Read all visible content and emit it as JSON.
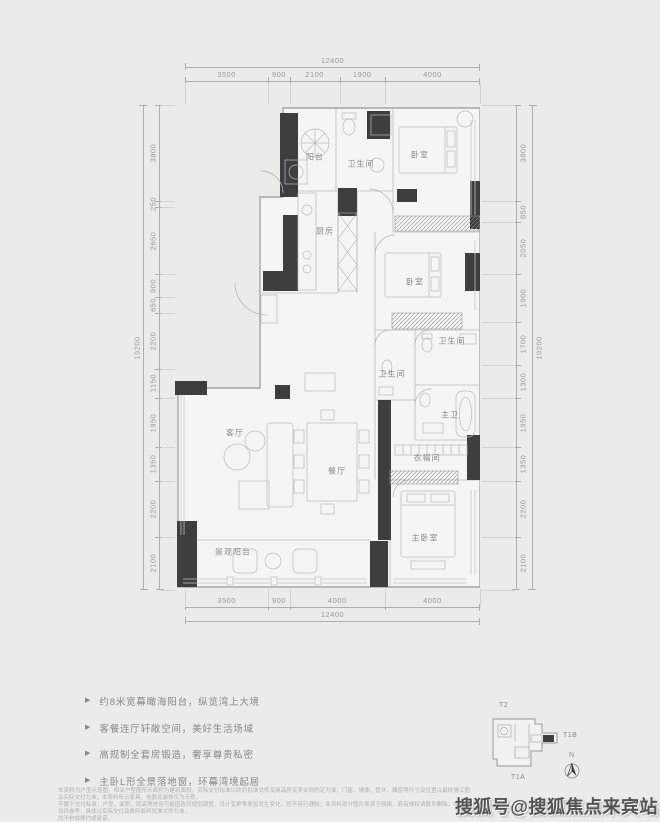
{
  "page": {
    "background": "#edebe8"
  },
  "dims": {
    "top": {
      "overall": "12400",
      "segments": [
        "3500",
        "900",
        "2100",
        "1900",
        "4000"
      ]
    },
    "bottom": {
      "overall": "12400",
      "segments": [
        "3500",
        "900",
        "4000",
        "4000"
      ]
    },
    "left": {
      "overall": "19200",
      "segments": [
        "3800",
        "250",
        "2650",
        "900",
        "650",
        "2200",
        "1150",
        "1950",
        "1350",
        "2200",
        "2100"
      ]
    },
    "right": {
      "overall": "19200",
      "segments": [
        "3800",
        "850",
        "2050",
        "1900",
        "1700",
        "1300",
        "1950",
        "1350",
        "2200",
        "2100"
      ]
    }
  },
  "plan": {
    "colors": {
      "wall": "#403e3d",
      "outline": "#a8a5a1",
      "fill": "#f6f5f3"
    },
    "rooms": [
      {
        "name": "阳台"
      },
      {
        "name": "卫生间"
      },
      {
        "name": "卧室"
      },
      {
        "name": "厨房"
      },
      {
        "name": "卧室"
      },
      {
        "name": "卫生间"
      },
      {
        "name": "卫生间"
      },
      {
        "name": "主卫"
      },
      {
        "name": "客厅"
      },
      {
        "name": "餐厅"
      },
      {
        "name": "衣帽间"
      },
      {
        "name": "主卧室"
      },
      {
        "name": "景观阳台"
      }
    ]
  },
  "features": {
    "bullet": "▶",
    "items": [
      "约8米宽幕瞰海阳台，纵览湾上大境",
      "客餐连厅轩敞空间，美好生活场域",
      "高规制全套房锻造，奢享尊贵私密",
      "主卧L形全景落地窗，环幕湾境起居"
    ]
  },
  "keyplan": {
    "t2": "T2",
    "t1b": "T1B",
    "t1a": "T1A",
    "north": "N"
  },
  "disclaimer": {
    "lines": [
      "本资料为户型示意图，相关户型图所示面积为建筑面积，实际交付标准以政府批准文件及商品房买卖合同约定为准；门窗、墙体、管井、飘窗等尺寸及位置以最终施工图及实际交付为准，本资料所示家具、电器及装饰仅为示意，",
      "不属于交付标准；户型、面积、层高等信息可能因政府规划调整、设计变更等原因发生变化，恕不另行通知；本资料部分图片来源于网络，若有侵权请联系删除；本资料仅供参考，具体以实际交付及政府最终批准文件为准，",
      "均不构成要约或承诺。"
    ]
  },
  "watermark": "搜狐号@搜狐焦点来宾站"
}
